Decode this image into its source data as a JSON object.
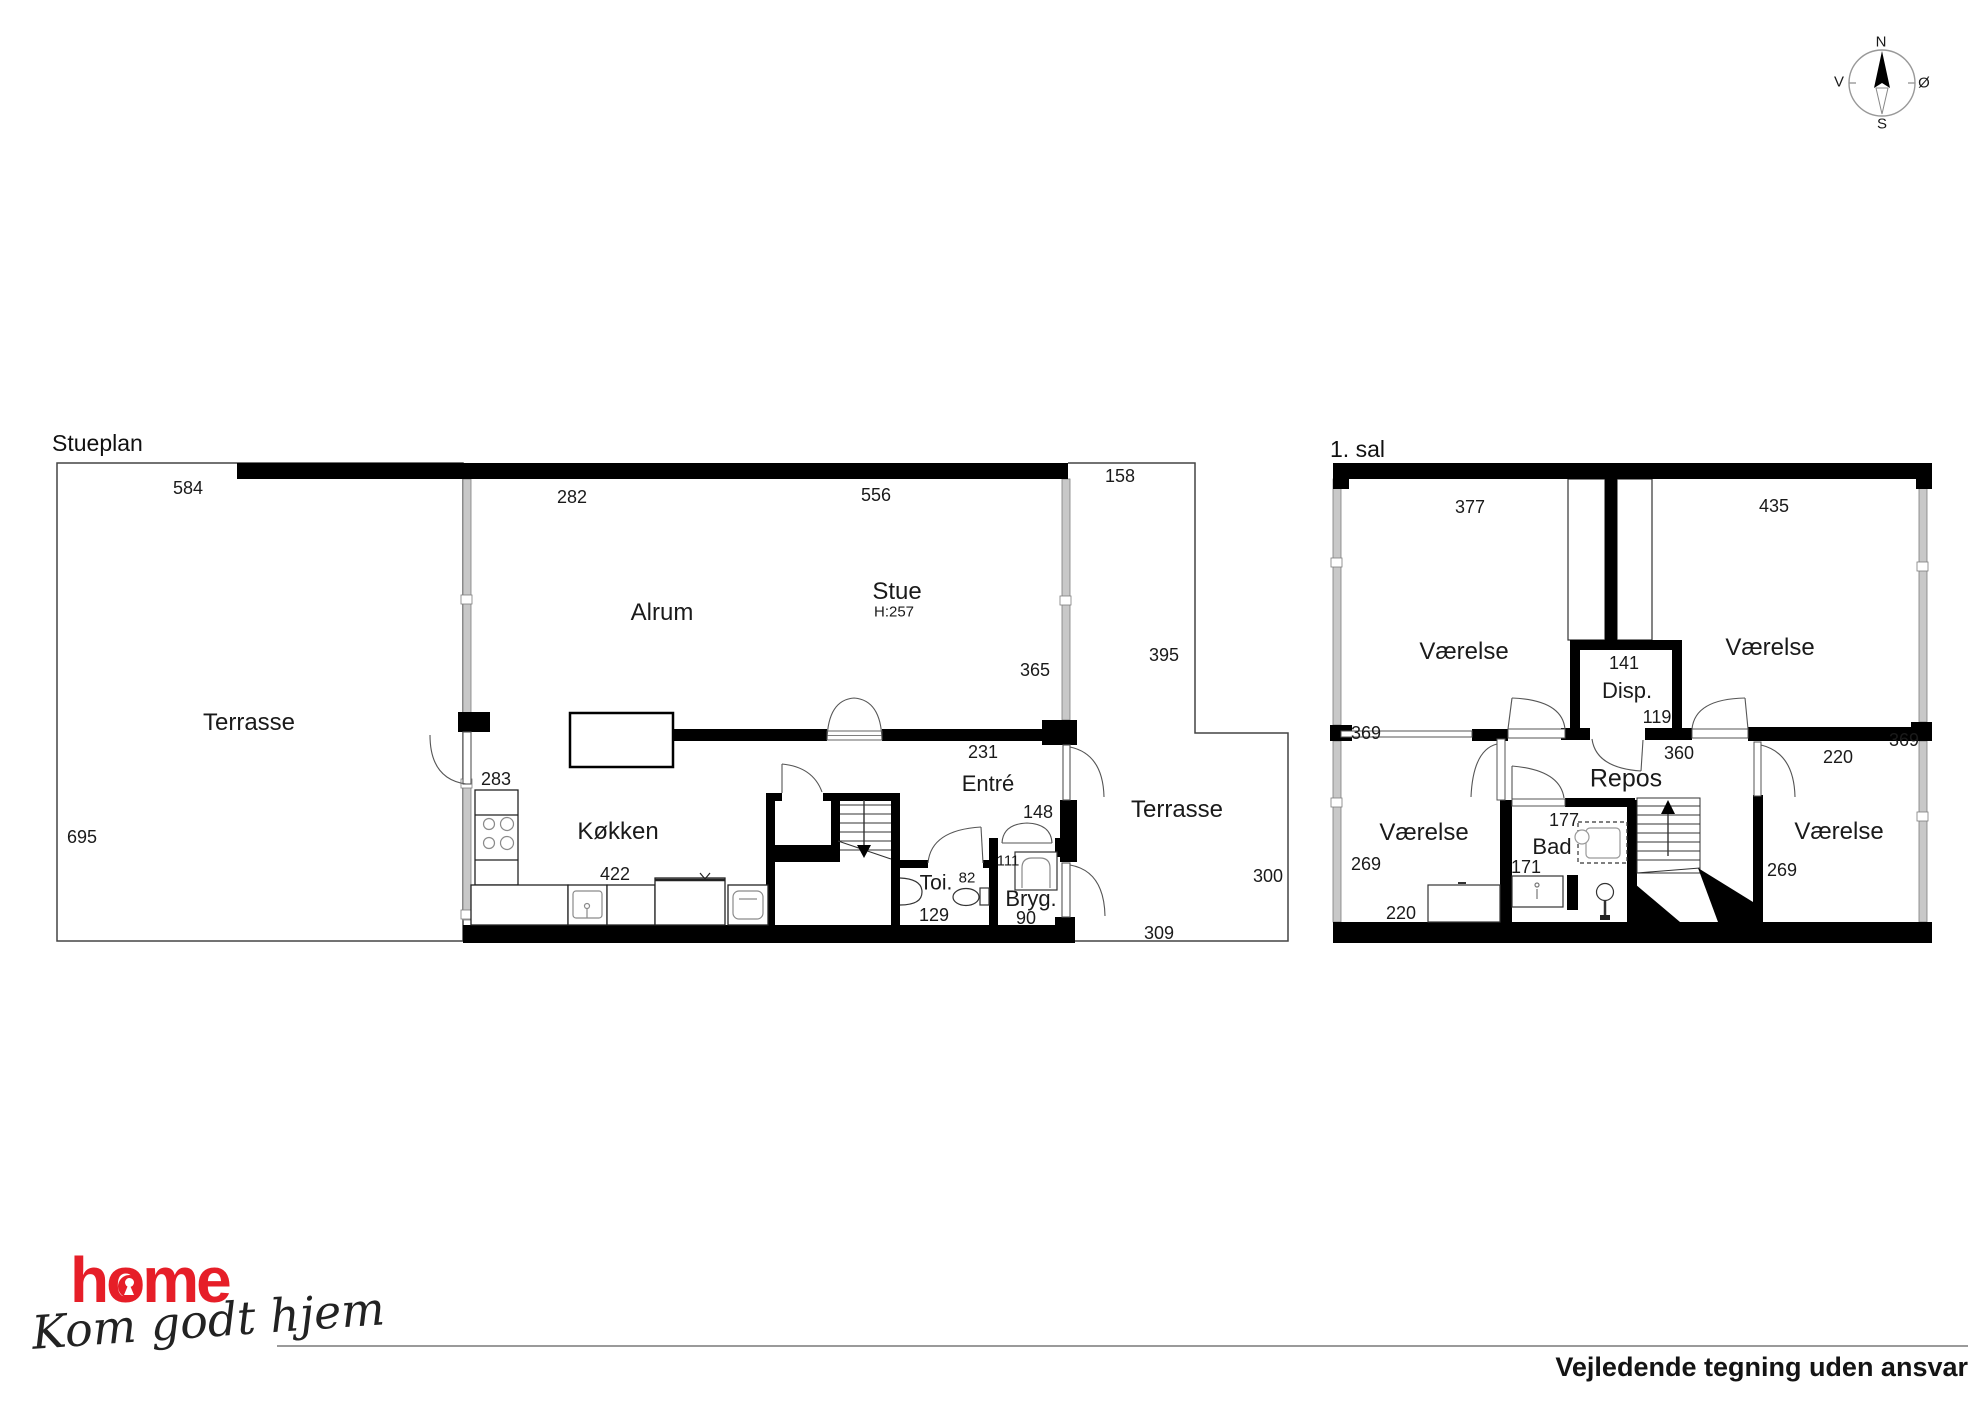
{
  "compass": {
    "north": "N",
    "south": "S",
    "west": "V",
    "east": "Ø"
  },
  "ground_floor": {
    "title": "Stueplan",
    "labels": {
      "terrace_left": "Terrasse",
      "alrum": "Alrum",
      "stue": "Stue",
      "stue_ceiling": "H:257",
      "kitchen": "Køkken",
      "toilet": "Toi.",
      "entry": "Entré",
      "utility": "Bryg.",
      "terrace_right": "Terrasse"
    },
    "dims": {
      "d584": "584",
      "d282": "282",
      "d556": "556",
      "d158": "158",
      "d695": "695",
      "d365": "365",
      "d395": "395",
      "d283": "283",
      "d422": "422",
      "d231": "231",
      "d148": "148",
      "d111": "111",
      "d82": "82",
      "d129": "129",
      "d90": "90",
      "d300": "300",
      "d309": "309"
    }
  },
  "first_floor": {
    "title": "1. sal",
    "labels": {
      "room_nw": "Værelse",
      "room_ne": "Værelse",
      "storage": "Disp.",
      "landing": "Repos",
      "bath": "Bad",
      "room_sw": "Værelse",
      "room_se": "Værelse"
    },
    "dims": {
      "d377": "377",
      "d435": "435",
      "d369_left": "369",
      "d369_right": "369",
      "d141": "141",
      "d119": "119",
      "d360": "360",
      "d220_landing": "220",
      "d177": "177",
      "d171": "171",
      "d269_left": "269",
      "d220_sw": "220",
      "d269_right": "269"
    }
  },
  "logo": {
    "brand": "home",
    "tagline": "Kom godt hjem",
    "brand_color": "#e61e28"
  },
  "footer": {
    "disclaimer": "Vejledende tegning uden ansvar"
  }
}
